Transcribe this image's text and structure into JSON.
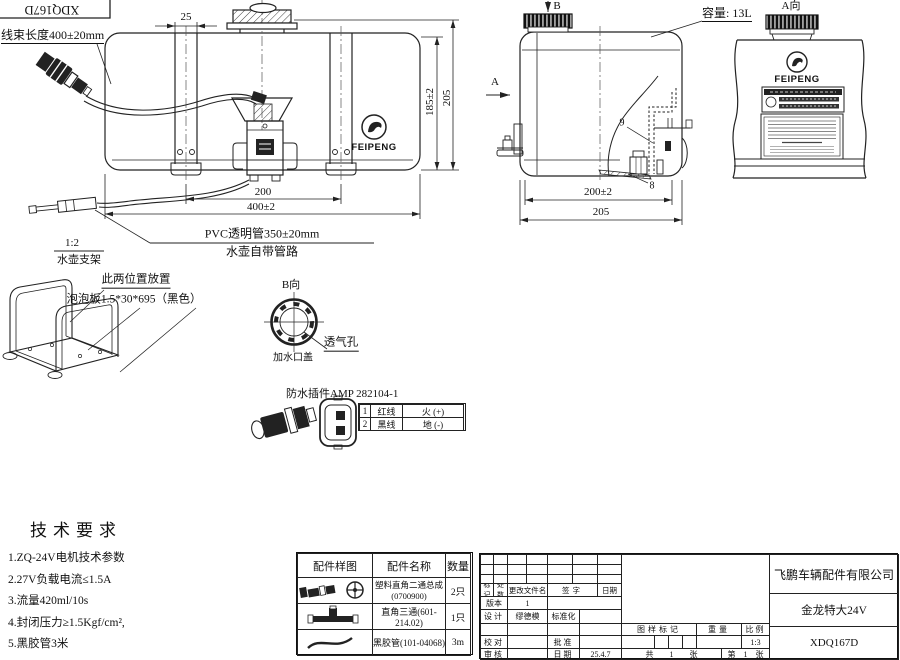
{
  "drawing": {
    "code_box": "XDQ167D",
    "harness_label": "线束长度400±20mm",
    "capacity_label": "容量: 13L",
    "view_a_label": "A向",
    "view_b_label": "B向",
    "arrow_a": "A",
    "arrow_b": "B",
    "feipeng_logo_text": "FEIPENG",
    "pvc_tube_label": "PVC透明管350±20mm",
    "tank_piping_label": "水壶自带管路",
    "bracket_scale": "1:2",
    "bracket_name": "水壶支架",
    "placement_note": "此两位置放置",
    "foam_note": "泡泡板1.5*30*695（黑色）",
    "filler_cap_label": "加水口盖",
    "vent_label": "透气孔",
    "callout_9": "9",
    "callout_8": "8",
    "dims": {
      "d25": "25",
      "d185": "185±2",
      "d205_front": "205",
      "d200_front": "200",
      "d400": "400±2",
      "d200_side": "200±2",
      "d205_side": "205"
    }
  },
  "waterproof_connector": {
    "title": "防水插件AMP 282104-1",
    "rows": [
      {
        "no": "1",
        "wire": "红线",
        "role": "火 (+)"
      },
      {
        "no": "2",
        "wire": "黑线",
        "role": "地 (-)"
      }
    ]
  },
  "tech_requirements": {
    "title": "技术要求",
    "items": [
      "1.ZQ-24V电机技术参数",
      "2.27V负载电流≤1.5A",
      "3.流量420ml/10s",
      "4.封闭压力≥1.5Kgf/cm²,",
      "5.黑胶管3米"
    ]
  },
  "parts_table": {
    "headers": [
      "配件样图",
      "配件名称",
      "数量"
    ],
    "rows": [
      {
        "name": "塑料直角二通总成\n(0700900)",
        "qty": "2只"
      },
      {
        "name": "直角三通(601-214.02)",
        "qty": "1只"
      },
      {
        "name": "黑胶管(101-04068)",
        "qty": "3m"
      }
    ]
  },
  "title_block": {
    "change_cols": [
      "标记",
      "处数",
      "更改文件名",
      "签字",
      "日期"
    ],
    "version_label": "版本",
    "version_value": "1",
    "design_label": "设计",
    "designer": "缪德模",
    "standard_label": "标准化",
    "proof_label": "校对",
    "approve_label": "批准",
    "audit_label": "审核",
    "date_label": "日期",
    "date_value": "25.4.7",
    "stamp_label": "图样标记",
    "weight_label": "重量",
    "scale_label": "比例",
    "scale_value": "1:3",
    "sheet_total": "共 1 张",
    "sheet_no": "第 1 张",
    "company": "飞鹏车辆配件有限公司",
    "product": "金龙特大24V",
    "drawing_no": "XDQ167D"
  }
}
